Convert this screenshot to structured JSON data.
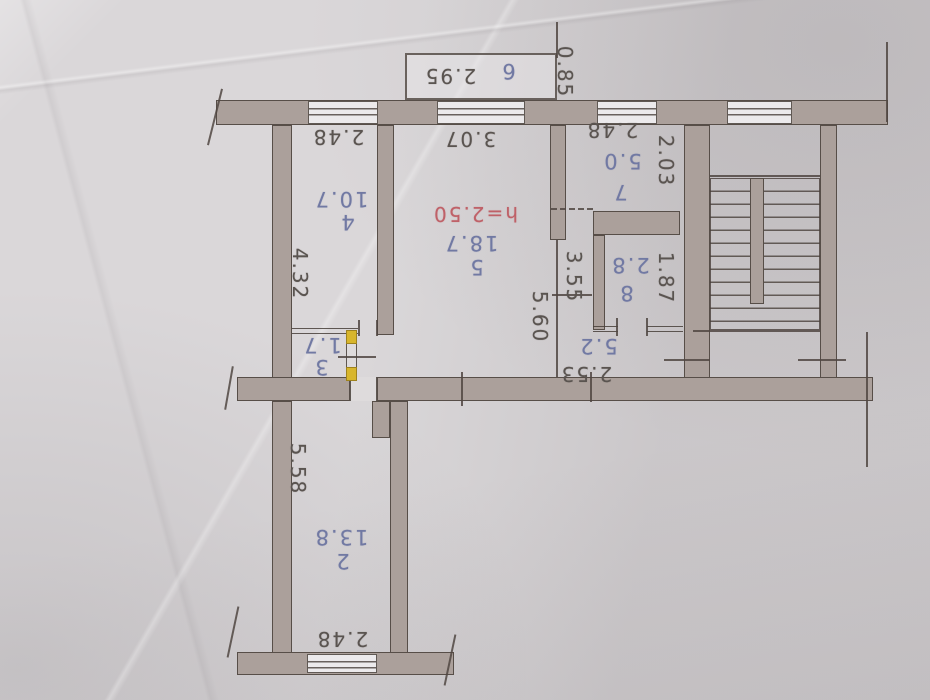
{
  "colors": {
    "paper": "#d6d3d5",
    "wall_fill": "#aba09b",
    "ink_line": "#50473f",
    "pencil_blue": "#7179a3",
    "pencil_red": "#bf6168",
    "highlight_yellow": "#d8b62c",
    "graphite": "#5a5450"
  },
  "floor_plan": {
    "orientation": "photo rotated 180 degrees (all text upside down)",
    "rooms": [
      {
        "number": "2",
        "area": "13.8",
        "dimensions": [
          "5.58",
          "2.48"
        ]
      },
      {
        "number": "3",
        "area": "1.7",
        "dimensions": []
      },
      {
        "number": "4",
        "area": "10.7",
        "dimensions": [
          "2.48",
          "4.32"
        ]
      },
      {
        "number": "5",
        "area": "18.7",
        "ceiling_height": "h=2.50",
        "dimensions": [
          "3.07",
          "5.60"
        ]
      },
      {
        "number": "6",
        "area": "",
        "dimensions": [
          "2.95",
          "0.85"
        ]
      },
      {
        "number": "7",
        "area": "5.0",
        "dimensions": [
          "2.48",
          "2.03"
        ]
      },
      {
        "number": "8",
        "area": "2.8",
        "dimensions": [
          "1.87"
        ]
      },
      {
        "number": "",
        "area": "5.2",
        "dimensions": [
          "3.55",
          "2.53"
        ]
      }
    ],
    "labels": [
      {
        "name": "balcony-length",
        "text": "2.95",
        "x": 450,
        "y": 76,
        "rot": 180,
        "color": "dark"
      },
      {
        "name": "balcony-number",
        "text": "6",
        "x": 508,
        "y": 71,
        "rot": 180,
        "color": "blue"
      },
      {
        "name": "balcony-depth",
        "text": "0.85",
        "x": 565,
        "y": 72,
        "rot": 90,
        "color": "dark"
      },
      {
        "name": "room4-width",
        "text": "2.48",
        "x": 338,
        "y": 137,
        "rot": 180,
        "color": "dark"
      },
      {
        "name": "room5-width",
        "text": "3.07",
        "x": 470,
        "y": 139,
        "rot": 180,
        "color": "dark"
      },
      {
        "name": "room7-width",
        "text": "2.48",
        "x": 612,
        "y": 130,
        "rot": 180,
        "color": "dark"
      },
      {
        "name": "room7-area",
        "text": "5.0",
        "x": 622,
        "y": 161,
        "rot": 180,
        "color": "blue"
      },
      {
        "name": "room7-number",
        "text": "7",
        "x": 620,
        "y": 192,
        "rot": 180,
        "color": "blue"
      },
      {
        "name": "room7-depth",
        "text": "2.03",
        "x": 666,
        "y": 161,
        "rot": 90,
        "color": "dark"
      },
      {
        "name": "room4-area",
        "text": "10.7",
        "x": 341,
        "y": 199,
        "rot": 180,
        "color": "blue"
      },
      {
        "name": "room4-number",
        "text": "4",
        "x": 347,
        "y": 222,
        "rot": 180,
        "color": "blue"
      },
      {
        "name": "room4-depth",
        "text": "4.32",
        "x": 300,
        "y": 274,
        "rot": 90,
        "color": "dark"
      },
      {
        "name": "room5-ceiling-height",
        "text": "h=2.50",
        "x": 475,
        "y": 214,
        "rot": 180,
        "color": "red"
      },
      {
        "name": "room5-area",
        "text": "18.7",
        "x": 471,
        "y": 243,
        "rot": 180,
        "color": "blue"
      },
      {
        "name": "room5-number",
        "text": "5",
        "x": 476,
        "y": 267,
        "rot": 180,
        "color": "blue"
      },
      {
        "name": "room5-depth",
        "text": "5.60",
        "x": 540,
        "y": 317,
        "rot": 90,
        "color": "dark"
      },
      {
        "name": "hall-depth",
        "text": "3.55",
        "x": 574,
        "y": 277,
        "rot": 90,
        "color": "dark"
      },
      {
        "name": "room8-area",
        "text": "2.8",
        "x": 630,
        "y": 265,
        "rot": 180,
        "color": "blue"
      },
      {
        "name": "room8-number",
        "text": "8",
        "x": 626,
        "y": 293,
        "rot": 180,
        "color": "blue"
      },
      {
        "name": "room8-depth",
        "text": "1.87",
        "x": 666,
        "y": 278,
        "rot": 90,
        "color": "dark"
      },
      {
        "name": "hall-area",
        "text": "5.2",
        "x": 598,
        "y": 346,
        "rot": 180,
        "color": "blue"
      },
      {
        "name": "hall-width",
        "text": "2.53",
        "x": 586,
        "y": 374,
        "rot": 180,
        "color": "dark"
      },
      {
        "name": "room3-area",
        "text": "1.7",
        "x": 322,
        "y": 345,
        "rot": 180,
        "color": "blue"
      },
      {
        "name": "room3-number",
        "text": "3",
        "x": 321,
        "y": 367,
        "rot": 180,
        "color": "blue"
      },
      {
        "name": "room2-depth",
        "text": "5.58",
        "x": 298,
        "y": 469,
        "rot": 90,
        "color": "dark"
      },
      {
        "name": "room2-area",
        "text": "13.8",
        "x": 341,
        "y": 537,
        "rot": 180,
        "color": "blue"
      },
      {
        "name": "room2-number",
        "text": "2",
        "x": 342,
        "y": 561,
        "rot": 180,
        "color": "blue"
      },
      {
        "name": "room2-width",
        "text": "2.48",
        "x": 342,
        "y": 639,
        "rot": 180,
        "color": "dark"
      }
    ]
  }
}
